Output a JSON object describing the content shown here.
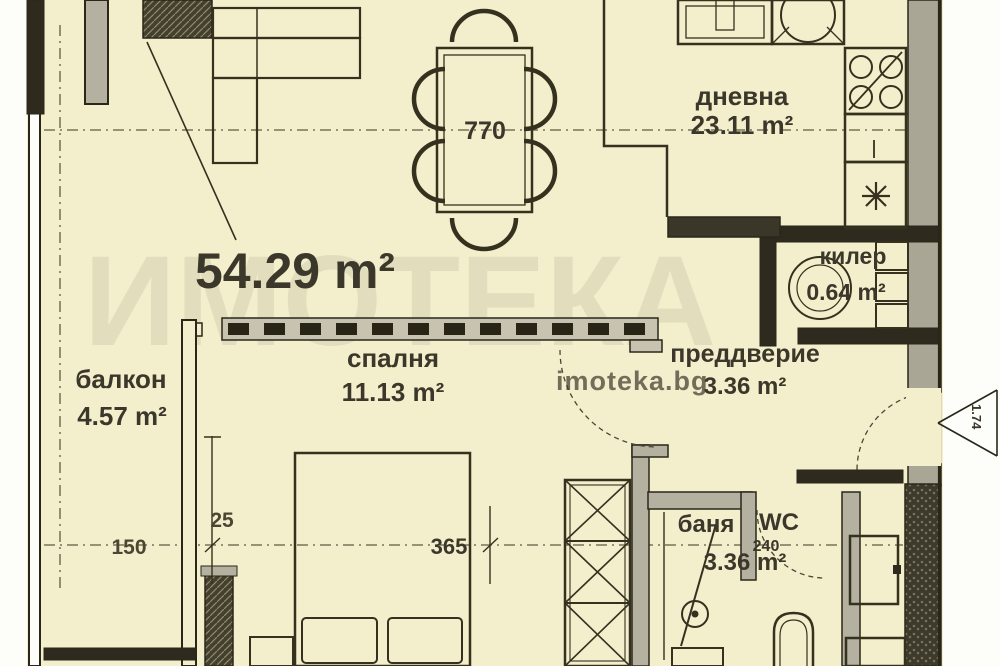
{
  "floor_plan": {
    "total_area": "54.29 m²",
    "rooms": {
      "living": {
        "label": "дневна",
        "area": "23.11 m²"
      },
      "bedroom": {
        "label": "спалня",
        "area": "11.13 m²"
      },
      "balcony": {
        "label": "балкон",
        "area": "4.57 m²"
      },
      "hallway": {
        "label": "преддверие",
        "area": "3.36 m²"
      },
      "storage": {
        "label": "килер",
        "area": "0.64 m²"
      },
      "bathroom": {
        "label": "баня",
        "label_wc": "WC",
        "area": "3.36 m²"
      }
    },
    "dimensions": {
      "dining_table": "770",
      "bedroom_width": "365",
      "balcony_width": "150",
      "wall_thickness": "25",
      "bathroom_width": "240",
      "entrance_width": "1.74"
    },
    "watermark": {
      "site": "imoteka.bg",
      "brand": "ИМОТЕКА"
    },
    "colors": {
      "background": "#f3efcc",
      "line": "#35311f",
      "wall_fill": "#b5b1a0",
      "dark_wall": "#2e2b1e",
      "text": "#3b372a",
      "dim_text": "#66624a",
      "faint_text": "#8d8a75",
      "watermark": "#a9a58d"
    }
  }
}
